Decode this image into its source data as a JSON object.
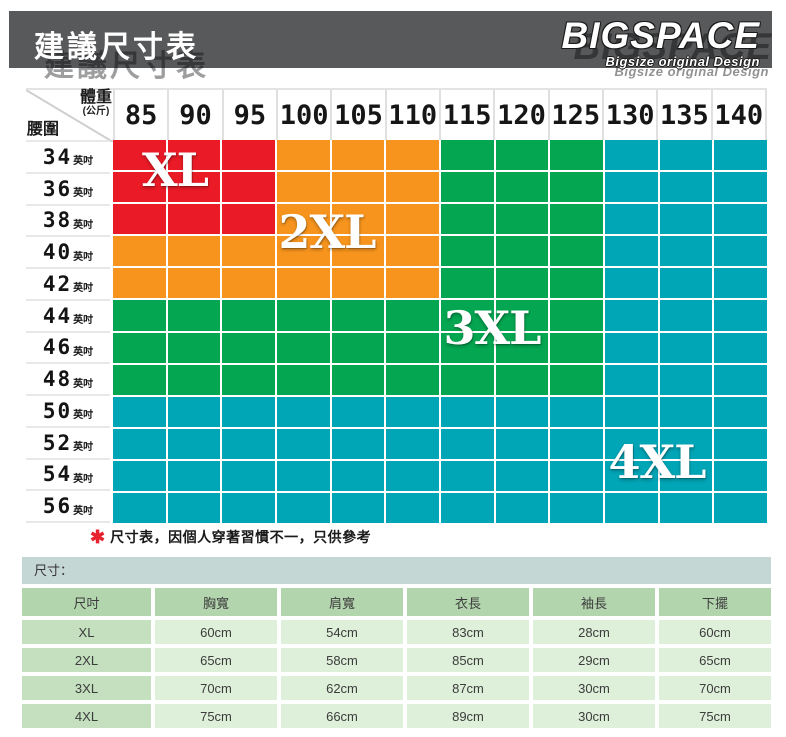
{
  "header": {
    "title": "建議尺寸表",
    "brand": "BIGSPACE",
    "brand_subtitle": "Bigsize original Design",
    "bar_color": "#58595b"
  },
  "grid": {
    "corner": {
      "weight_label": "體重",
      "weight_unit": "(公斤)",
      "waist_label": "腰圍"
    },
    "waist_unit": "英吋",
    "render": {
      "regions": [
        {
          "label": "XL",
          "color": "#ea1b26",
          "cols": 3,
          "rows": 3,
          "label_left": 62,
          "label_top": 30
        },
        {
          "label": "2XL",
          "color": "#f7941d",
          "cols": 6,
          "rows": 5,
          "label_left": 214,
          "label_top": 92
        },
        {
          "label": "3XL",
          "color": "#04a651",
          "cols": 9,
          "rows": 8,
          "label_left": 379,
          "label_top": 188
        },
        {
          "label": "4XL",
          "color": "#00a5b6",
          "cols": 12,
          "rows": 12,
          "label_left": 544,
          "label_top": 322
        }
      ]
    }
  },
  "note": {
    "mark": "✱",
    "mark_color": "#e8212e",
    "text": "尺寸表，因個人穿著習慣不一，只供參考"
  },
  "size_section": {
    "band_label": "尺寸："
  },
  "chart_data": [
    {
      "type": "heatmap",
      "title": "建議尺寸表",
      "xlabel": "體重(公斤)",
      "ylabel": "腰圍(英吋)",
      "x": [
        85,
        90,
        95,
        100,
        105,
        110,
        115,
        120,
        125,
        130,
        135,
        140
      ],
      "y": [
        34,
        36,
        38,
        40,
        42,
        44,
        46,
        48,
        50,
        52,
        54,
        56
      ],
      "zones": [
        {
          "label": "XL",
          "color": "#ea1b26",
          "weight_range": [
            85,
            95
          ],
          "waist_range": [
            34,
            38
          ]
        },
        {
          "label": "2XL",
          "color": "#f7941d",
          "weight_range": [
            85,
            110
          ],
          "waist_range": [
            34,
            42
          ],
          "note": "L-shape excluding XL zone"
        },
        {
          "label": "3XL",
          "color": "#04a651",
          "weight_range": [
            85,
            125
          ],
          "waist_range": [
            34,
            48
          ],
          "note": "L-shape excluding XL/2XL zones"
        },
        {
          "label": "4XL",
          "color": "#00a5b6",
          "weight_range": [
            85,
            140
          ],
          "waist_range": [
            34,
            56
          ],
          "note": "remaining cells"
        }
      ],
      "grid": true,
      "legend_position": "labels drawn inside zones"
    },
    {
      "type": "table",
      "columns": [
        "尺吋",
        "胸寬",
        "肩寬",
        "衣長",
        "袖長",
        "下擺"
      ],
      "rows": [
        [
          "XL",
          "60cm",
          "54cm",
          "83cm",
          "28cm",
          "60cm"
        ],
        [
          "2XL",
          "65cm",
          "58cm",
          "85cm",
          "29cm",
          "65cm"
        ],
        [
          "3XL",
          "70cm",
          "62cm",
          "87cm",
          "30cm",
          "70cm"
        ],
        [
          "4XL",
          "75cm",
          "66cm",
          "89cm",
          "30cm",
          "75cm"
        ]
      ]
    }
  ]
}
